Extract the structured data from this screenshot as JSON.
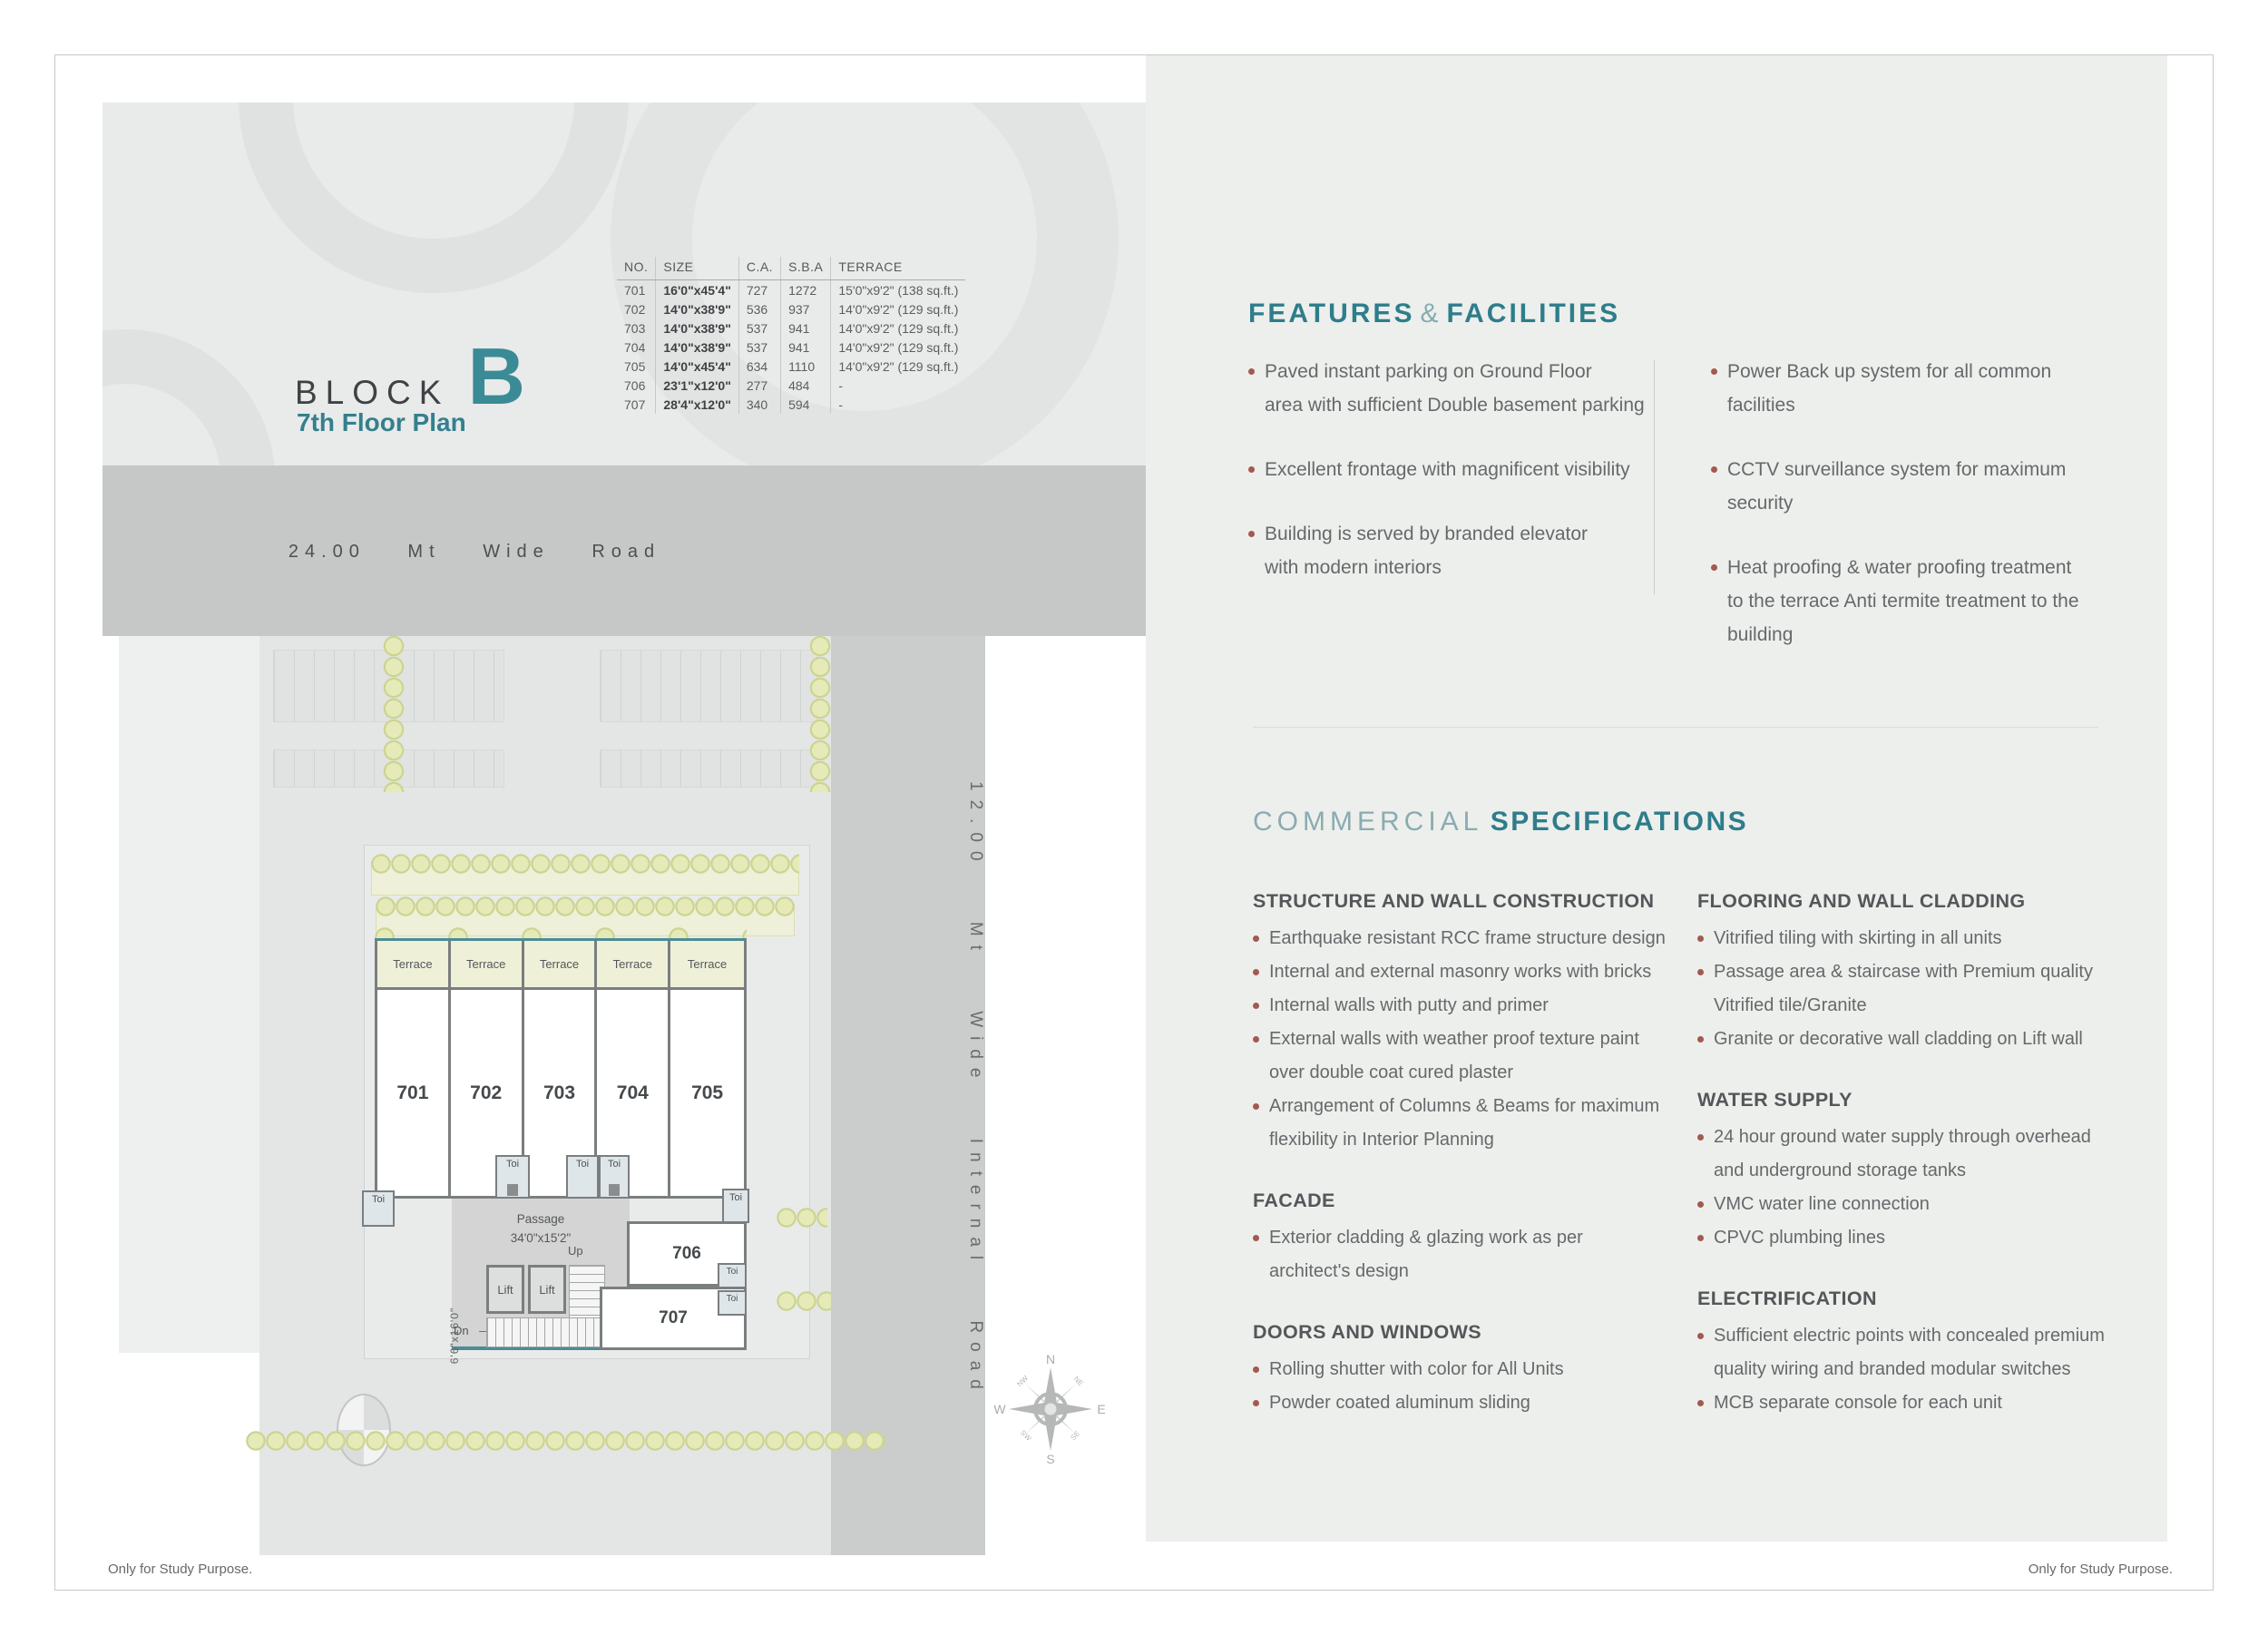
{
  "page": {
    "block_word": "BLOCK",
    "block_letter": "B",
    "floor_label": "7th Floor Plan",
    "footer_left": "Only for Study Purpose.",
    "footer_right": "Only for Study Purpose."
  },
  "unit_table": {
    "headers": [
      "NO.",
      "SIZE",
      "C.A.",
      "S.B.A",
      "TERRACE"
    ],
    "rows": [
      [
        "701",
        "16'0\"x45'4\"",
        "727",
        "1272",
        "15'0\"x9'2\" (138 sq.ft.)"
      ],
      [
        "702",
        "14'0\"x38'9\"",
        "536",
        "937",
        "14'0\"x9'2\" (129 sq.ft.)"
      ],
      [
        "703",
        "14'0\"x38'9\"",
        "537",
        "941",
        "14'0\"x9'2\" (129 sq.ft.)"
      ],
      [
        "704",
        "14'0\"x38'9\"",
        "537",
        "941",
        "14'0\"x9'2\" (129 sq.ft.)"
      ],
      [
        "705",
        "14'0\"x45'4\"",
        "634",
        "1110",
        "14'0\"x9'2\" (129 sq.ft.)"
      ],
      [
        "706",
        "23'1\"x12'0\"",
        "277",
        "484",
        "-"
      ],
      [
        "707",
        "28'4\"x12'0\"",
        "340",
        "594",
        "-"
      ]
    ]
  },
  "plan": {
    "road_top": "24.00 Mt Wide Road",
    "road_right": "12.00 Mt Wide Internal Road",
    "terrace_label": "Terrace",
    "units": [
      "701",
      "702",
      "703",
      "704",
      "705"
    ],
    "unit_706": "706",
    "unit_707": "707",
    "toi_label": "Toi",
    "passage_line1": "Passage",
    "passage_line2": "34'0\"x15'2\"",
    "lift_label": "Lift",
    "up_label": "Up",
    "dn_label": "Dn",
    "stair_size": "6'6\"x16'0\"",
    "compass": {
      "n": "N",
      "e": "E",
      "s": "S",
      "w": "W",
      "ne": "NE",
      "nw": "NW",
      "se": "SE",
      "sw": "SW"
    }
  },
  "features": {
    "title_1": "FEATURES",
    "title_amp": "&",
    "title_2": "FACILITIES",
    "left": [
      [
        "Paved instant parking on Ground Floor",
        "area with sufficient Double basement parking"
      ],
      [
        "Excellent frontage with magnificent visibility"
      ],
      [
        "Building is served by branded elevator",
        "with modern interiors"
      ]
    ],
    "right": [
      [
        "Power Back up system for all common facilities"
      ],
      [
        "CCTV surveillance system for maximum security"
      ],
      [
        "Heat proofing & water proofing treatment",
        "to the terrace Anti termite treatment to the building"
      ]
    ]
  },
  "specs": {
    "title_1": "COMMERCIAL",
    "title_2": "SPECIFICATIONS",
    "left_sections": [
      {
        "heading": "STRUCTURE AND WALL CONSTRUCTION",
        "items": [
          [
            "Earthquake resistant RCC frame structure design"
          ],
          [
            "Internal and external masonry works with bricks"
          ],
          [
            "Internal walls with putty and primer"
          ],
          [
            "External walls with weather proof texture paint",
            "over double coat cured plaster"
          ],
          [
            "Arrangement of Columns & Beams for maximum",
            "flexibility in Interior Planning"
          ]
        ]
      },
      {
        "heading": "FACADE",
        "items": [
          [
            "Exterior cladding & glazing work as per",
            "architect's design"
          ]
        ]
      },
      {
        "heading": "DOORS AND WINDOWS",
        "items": [
          [
            "Rolling shutter with color for All Units"
          ],
          [
            "Powder coated aluminum sliding"
          ]
        ]
      }
    ],
    "right_sections": [
      {
        "heading": "FLOORING AND WALL CLADDING",
        "items": [
          [
            "Vitrified tiling with skirting in all units"
          ],
          [
            "Passage area & staircase with Premium quality",
            "Vitrified tile/Granite"
          ],
          [
            "Granite or decorative wall cladding on Lift wall"
          ]
        ]
      },
      {
        "heading": "WATER SUPPLY",
        "items": [
          [
            "24 hour ground water supply through overhead",
            "and underground storage tanks"
          ],
          [
            "VMC water line connection"
          ],
          [
            "CPVC plumbing lines"
          ]
        ]
      },
      {
        "heading": "ELECTRIFICATION",
        "items": [
          [
            "Sufficient electric points with concealed premium",
            "quality wiring and branded modular switches"
          ],
          [
            "MCB separate console for each unit"
          ]
        ]
      }
    ]
  },
  "colors": {
    "accent_teal": "#2e7d8b",
    "bullet": "#a2594f",
    "terrace_fill": "#eef0d8",
    "wall": "#7b7e7f"
  }
}
